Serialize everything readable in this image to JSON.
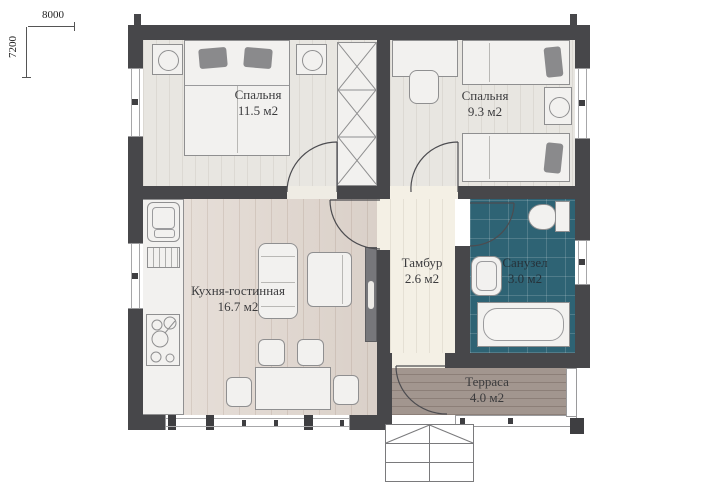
{
  "dimensions": {
    "width": "8000",
    "height": "7200"
  },
  "rooms": [
    {
      "id": "bedroom1",
      "name": "Спальня",
      "area": "11.5 м2"
    },
    {
      "id": "bedroom2",
      "name": "Спальня",
      "area": "9.3 м2"
    },
    {
      "id": "kitchen",
      "name": "Кухня-гостинная",
      "area": "16.7 м2"
    },
    {
      "id": "vestibule",
      "name": "Тамбур",
      "area": "2.6 м2"
    },
    {
      "id": "bathroom",
      "name": "Санузел",
      "area": "3.0 м2"
    },
    {
      "id": "terrace",
      "name": "Терраса",
      "area": "4.0 м2"
    }
  ],
  "colors": {
    "wall": "#47474a",
    "bedroom_floor": "#e8e6e1",
    "kitchen_floor": "#e1d7cf",
    "vestibule_floor": "#f4f0e5",
    "bathroom_tile": "#2e6374",
    "terrace_deck": "#a2968f",
    "furniture_fill": "#f2f1ef",
    "furniture_stroke": "#8f8f90",
    "pillow": "#8a8a8c",
    "label_text": "#3b3b3d"
  }
}
